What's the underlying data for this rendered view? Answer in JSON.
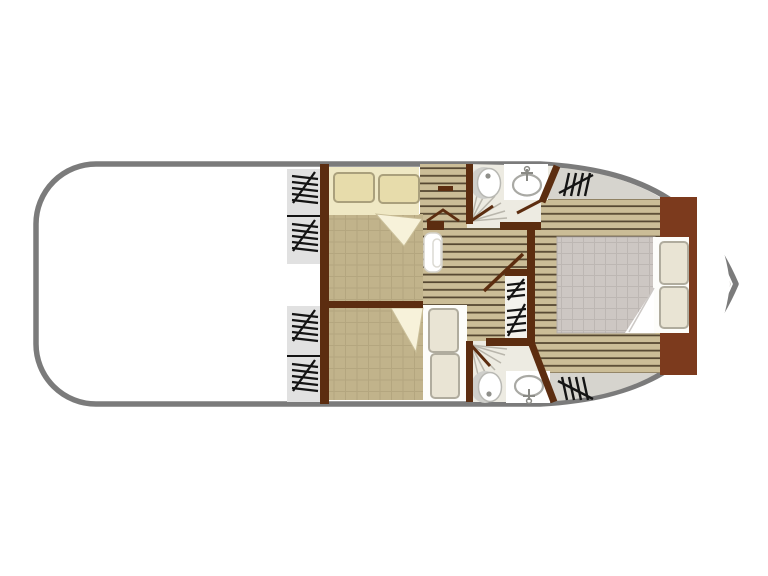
{
  "floorplan": {
    "kind": "boat-deck-floorplan",
    "orientation": "bow-right",
    "rooms": [
      {
        "name": "aft-open-deck",
        "contents": []
      },
      {
        "name": "guest-cabin-top",
        "contents": [
          "double-bed",
          "two-pillows",
          "folded-blanket-corner"
        ]
      },
      {
        "name": "guest-cabin-bottom",
        "contents": [
          "double-bed",
          "two-pillows",
          "folded-blanket-corner"
        ]
      },
      {
        "name": "bathroom-top",
        "contents": [
          "toilet",
          "washbasin",
          "shower"
        ]
      },
      {
        "name": "bathroom-bottom",
        "contents": [
          "toilet",
          "washbasin",
          "shower"
        ]
      },
      {
        "name": "corridor",
        "contents": [
          "entry-steps"
        ]
      },
      {
        "name": "master-cabin-bow",
        "contents": [
          "double-bed",
          "two-pillows",
          "folded-blanket-corner",
          "bow-lockers"
        ]
      }
    ],
    "stairs": [
      "side-steps-top-upper",
      "side-steps-top-lower",
      "side-steps-bottom-upper",
      "side-steps-bottom-lower",
      "companionway-mid",
      "bow-gangway-top",
      "bow-gangway-bottom"
    ]
  },
  "colors": {
    "hull_outline": "#7b7b7b",
    "hull_fill": "#ffffff",
    "deck_gray": "#d6d4ce",
    "stairs_gray": "#e1e1e1",
    "wall": "#5c2d10",
    "cabinet": "#7c3a1d",
    "plank_bg": "#cbbd97",
    "plank_line": "#564832",
    "blanket_bg": "#c1b38b",
    "blanket_line": "#ab9d76",
    "sheet_cream": "#efe8c4",
    "pillow_cream": "#e7dcab",
    "pillow_cream_stroke": "#aaa07c",
    "sheet_white": "#fdfdfa",
    "pillow_white": "#e9e4d4",
    "pillow_white_stroke": "#b0ac9e",
    "master_blanket_bg": "#cdc7c3",
    "master_blanket_line": "#b9b3af",
    "bath_floor": "#edebe2",
    "fixture_stroke": "#a9a9a4",
    "shower_line": "#b9b6ac",
    "hatch_black": "#141414",
    "fold": "#f7f2da",
    "mid_stairs_bg": "#f3f2ed"
  }
}
